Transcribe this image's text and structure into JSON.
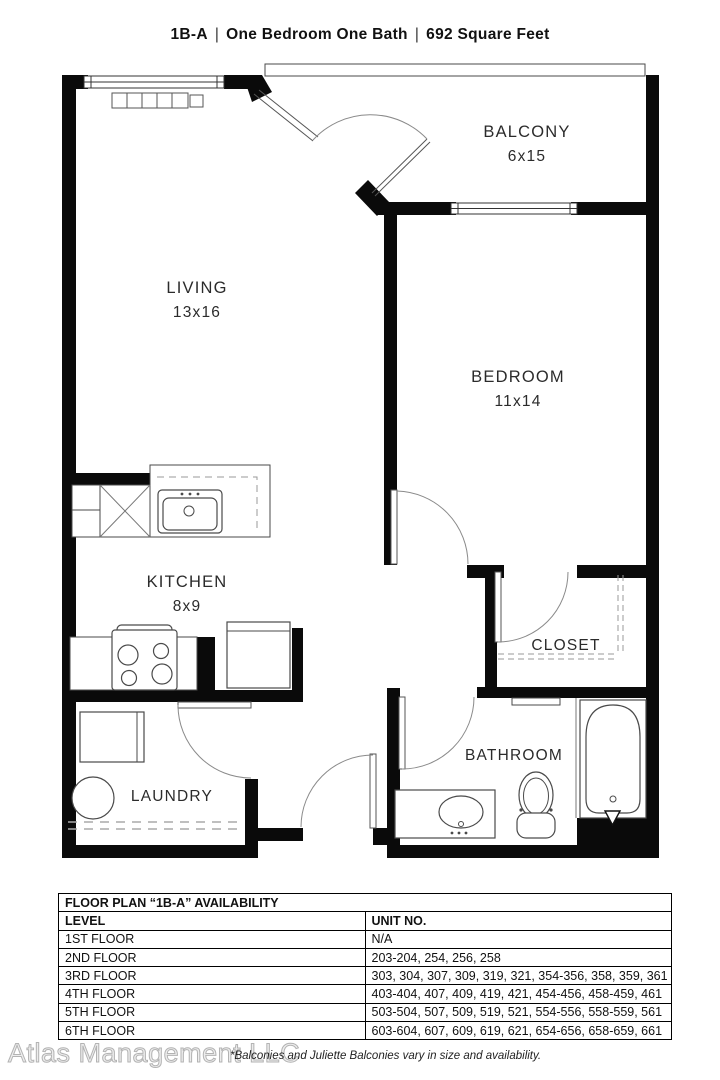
{
  "title": {
    "unit": "1B-A",
    "separator": "|",
    "type": "One Bedroom One Bath",
    "area": "692 Square Feet"
  },
  "rooms": {
    "balcony": {
      "label": "BALCONY",
      "dims": "6x15"
    },
    "living": {
      "label": "LIVING",
      "dims": "13x16"
    },
    "bedroom": {
      "label": "BEDROOM",
      "dims": "11x14"
    },
    "kitchen": {
      "label": "KITCHEN",
      "dims": "8x9"
    },
    "closet": {
      "label": "CLOSET"
    },
    "laundry": {
      "label": "LAUNDRY"
    },
    "bathroom": {
      "label": "BATHROOM"
    }
  },
  "availability": {
    "title": "FLOOR PLAN “1B-A” AVAILABILITY",
    "columns": [
      "LEVEL",
      "UNIT NO."
    ],
    "rows": [
      [
        "1ST FLOOR",
        "N/A"
      ],
      [
        "2ND FLOOR",
        "203-204, 254, 256, 258"
      ],
      [
        "3RD FLOOR",
        "303, 304, 307, 309, 319, 321, 354-356, 358, 359, 361"
      ],
      [
        "4TH FLOOR",
        "403-404, 407, 409, 419, 421, 454-456, 458-459, 461"
      ],
      [
        "5TH FLOOR",
        "503-504, 507, 509, 519, 521, 554-556, 558-559, 561"
      ],
      [
        "6TH FLOOR",
        "603-604, 607, 609, 619, 621, 654-656, 658-659, 661"
      ]
    ]
  },
  "footer": {
    "watermark": "Atlas Management LLC",
    "note": "*Balconies and Juliette Balconies vary in size and availability."
  }
}
